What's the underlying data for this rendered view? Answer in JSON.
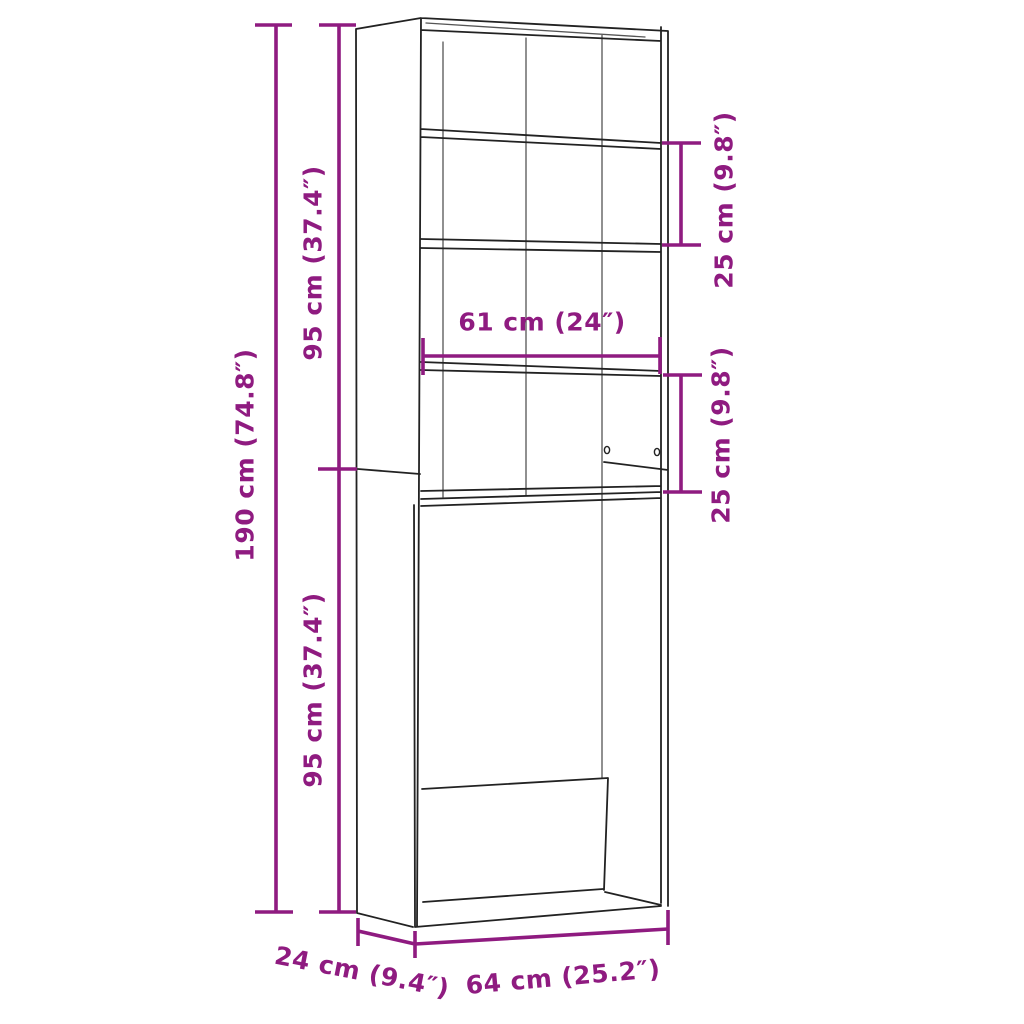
{
  "diagram": {
    "labels": {
      "upper_height": "95 cm (37.4″)",
      "total_height": "190 cm (74.8″)",
      "lower_height": "95 cm (37.4″)",
      "upper_shelf_gap": "25 cm (9.8″)",
      "inner_width": "61 cm (24″)",
      "lower_shelf_gap": "25 cm (9.8″)",
      "depth": "24 cm (9.4″)",
      "total_width": "64 cm (25.2″)"
    },
    "colors": {
      "dimension": "#8F1B80",
      "outline": "#222222",
      "seam": "#555555",
      "background": "#FFFFFF"
    }
  }
}
